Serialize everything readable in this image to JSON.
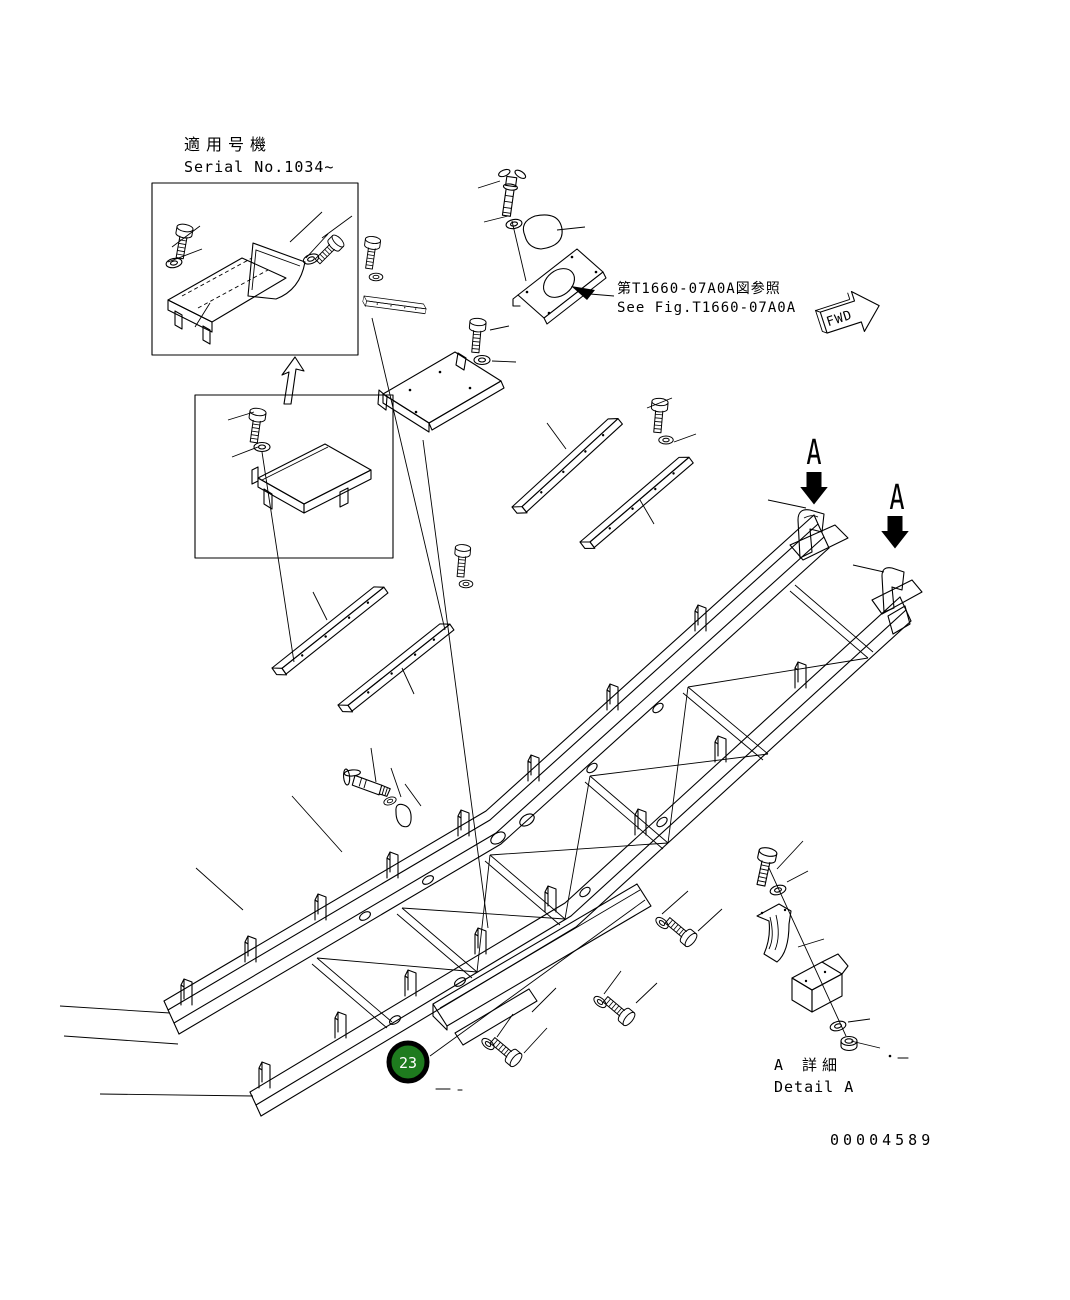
{
  "colors": {
    "line": "#000000",
    "background": "#ffffff",
    "callout_fill": "#1e7b1e",
    "callout_ring": "#000000",
    "callout_text": "#ffffff",
    "marker_arrow": "#000000"
  },
  "header": {
    "applicable_machine_jp": "適用号機",
    "serial_range": "Serial No.1034~"
  },
  "reference": {
    "see_fig_jp": "第T1660-07A0A図参照",
    "see_fig_en": "See Fig.T1660-07A0A"
  },
  "orientation": {
    "fwd_label": "FWD"
  },
  "detail": {
    "title_jp": "A 詳細",
    "title_en": "Detail A",
    "section_marker": "A"
  },
  "callouts": {
    "part_23": "23"
  },
  "footer": {
    "drawing_number": "00004589"
  }
}
